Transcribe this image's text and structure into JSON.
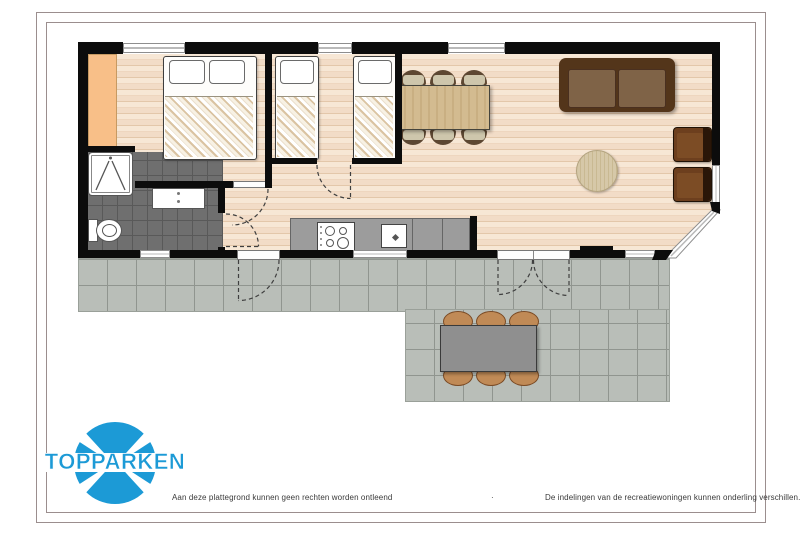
{
  "logo": {
    "text": "TOPPARKEN",
    "brand_color": "#1c9ad6"
  },
  "footer": {
    "left_text": "Aan deze plattegrond kunnen geen rechten worden ontleend",
    "separator": "·",
    "right_text": "De indelingen van de recreatiewoningen kunnen onderling verschillen."
  },
  "colors": {
    "wall": "#0c0c0c",
    "floor": "#f2dcc7",
    "floor-line": "#e3c7aa",
    "tile": "#6f6f6f",
    "tile-line": "#595959",
    "terrace": "#b9beb8",
    "terrace-line": "#90958f",
    "wardrobe": "#f8bf88",
    "counter": "#9c9c9c",
    "sofa-frame": "#53351a",
    "sofa-cushion": "#7f6347",
    "armchair": "#6d3f1e",
    "table-wood": "#d3bb90",
    "chair-seat": "#cec6ac",
    "chair-frame": "#5d4732",
    "rug": "#d6c8a8",
    "outdoor-table": "#8f8f8f",
    "outdoor-chair": "#c08a56",
    "brand": "#1c9ad6",
    "frame": "#9b8e8e"
  }
}
